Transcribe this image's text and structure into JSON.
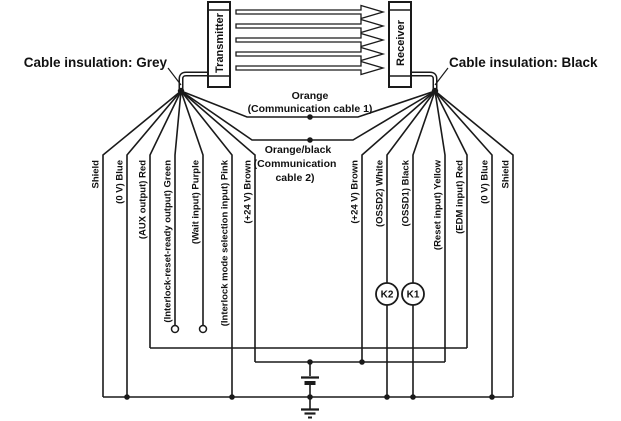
{
  "left_cable": {
    "title": "Cable insulation: Grey"
  },
  "right_cable": {
    "title": "Cable insulation: Black"
  },
  "devices": {
    "transmitter": "Transmitter",
    "receiver": "Receiver"
  },
  "comm_cables": {
    "cable1": {
      "color": "Orange",
      "caption": "(Communication cable 1)"
    },
    "cable2": {
      "color": "Orange/black",
      "caption_line1": "(Communication",
      "caption_line2": "cable 2)"
    }
  },
  "wires": {
    "left": [
      {
        "label": "Shield"
      },
      {
        "label": "(0 V) Blue"
      },
      {
        "label": "(AUX output) Red"
      },
      {
        "label": "(Interlock-reset-ready output) Green"
      },
      {
        "label": "(Wait input) Purple"
      },
      {
        "label": "(Interlock mode selection input) Pink"
      },
      {
        "label": "(+24 V) Brown"
      }
    ],
    "right": [
      {
        "label": "(+24 V) Brown"
      },
      {
        "label": "(OSSD2) White"
      },
      {
        "label": "(OSSD1) Black"
      },
      {
        "label": "(Reset input) Yellow"
      },
      {
        "label": "(EDM input) Red"
      },
      {
        "label": "(0 V) Blue"
      },
      {
        "label": "Shield"
      }
    ]
  },
  "relays": {
    "k2": "K2",
    "k1": "K1"
  },
  "colors": {
    "line": "#1a1a1a",
    "background": "#ffffff"
  }
}
